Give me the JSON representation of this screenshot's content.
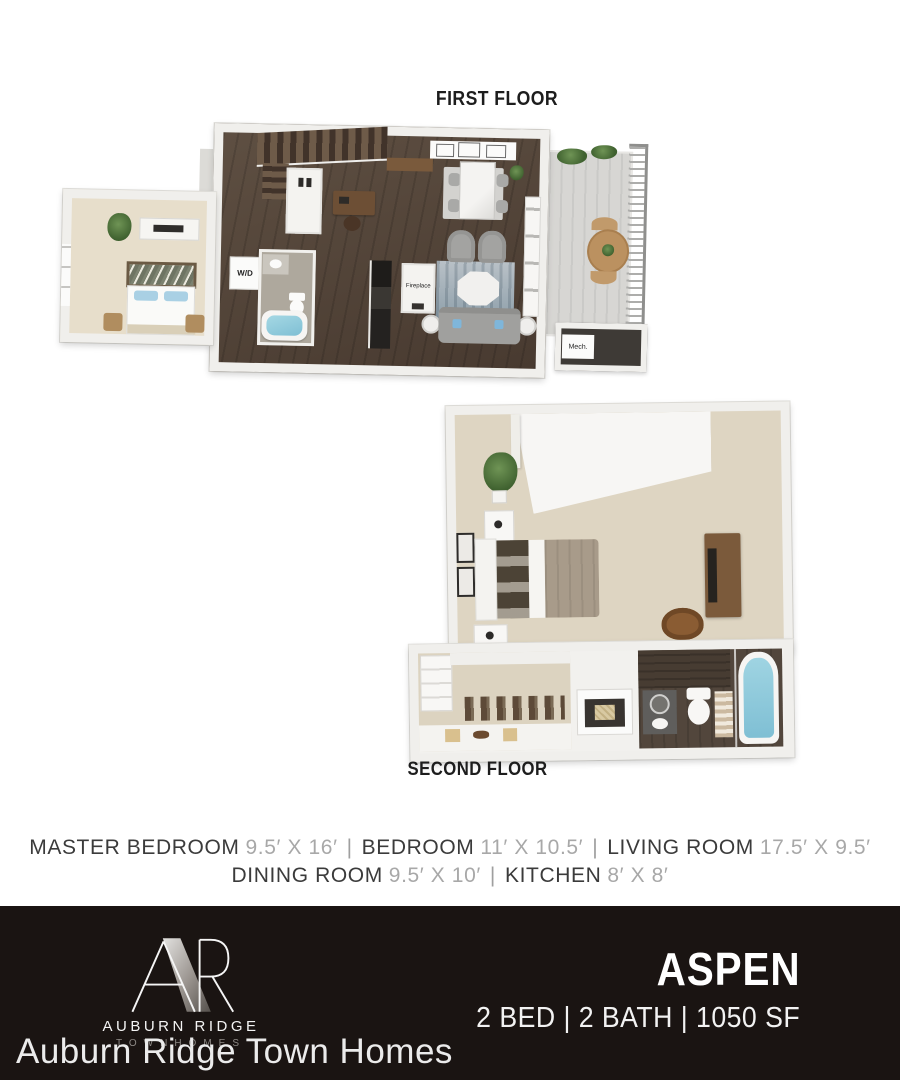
{
  "page": {
    "background": "#ffffff"
  },
  "floors": {
    "first": {
      "label": "FIRST FLOOR",
      "labels": {
        "washer_dryer": "W/D",
        "fireplace": "Fireplace",
        "mechanical": "Mech."
      }
    },
    "second": {
      "label": "SECOND FLOOR"
    }
  },
  "dimensions": {
    "separator": "|",
    "line1": [
      {
        "room": "MASTER BEDROOM",
        "size": "9.5′ X 16′"
      },
      {
        "room": "BEDROOM",
        "size": "11′ X 10.5′"
      },
      {
        "room": "LIVING ROOM",
        "size": "17.5′ X 9.5′"
      }
    ],
    "line2": [
      {
        "room": "DINING ROOM",
        "size": "9.5′ X 10′"
      },
      {
        "room": "KITCHEN",
        "size": "8′ X 8′"
      }
    ]
  },
  "footer": {
    "background": "#1a1412",
    "brand": {
      "monogram": "AR",
      "name": "AUBURN RIDGE",
      "subtitle": "TOWNHOMES"
    },
    "plan": {
      "name": "ASPEN",
      "specs": "2 BED | 2 BATH | 1050 SF"
    }
  },
  "watermark": "Auburn Ridge Town Homes",
  "colors": {
    "wood_floor": "#54463b",
    "carpet": "#ded5c2",
    "bedroom_floor": "#e7decb",
    "wall": "#f0efec",
    "water": "#8ecadb",
    "deck": "#d7d6d3",
    "dim_room_text": "#3b3b3b",
    "dim_size_text": "#a8a8a8",
    "footer_text": "#ffffff"
  }
}
